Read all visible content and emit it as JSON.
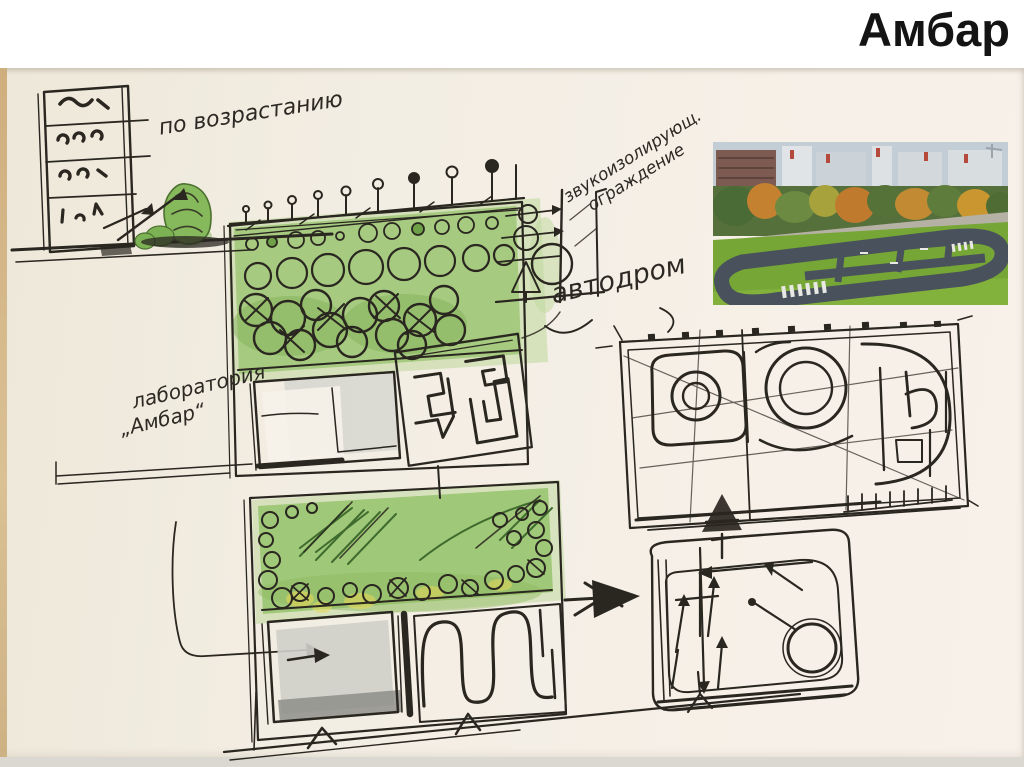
{
  "slide": {
    "title": "Амбар"
  },
  "annotations": {
    "ascending": "по возрастанию",
    "soundproof_line1": "звукоизолирующ.",
    "soundproof_line2": "ограждение",
    "autodrome": "автодром",
    "lab_line1": "лаборатория",
    "lab_line2": "„Амбар“"
  },
  "colors": {
    "ink": "#2a2620",
    "paper": "#f3eee4",
    "green_marker": "#a6ca80",
    "green_dark": "#6ea047",
    "yellow_marker": "#ddd45a",
    "gray_marker": "#d6d6d0",
    "title": "#141414",
    "render_road": "#49525c",
    "render_lawn": "#76a635",
    "render_sky": "#c2cdd6"
  }
}
